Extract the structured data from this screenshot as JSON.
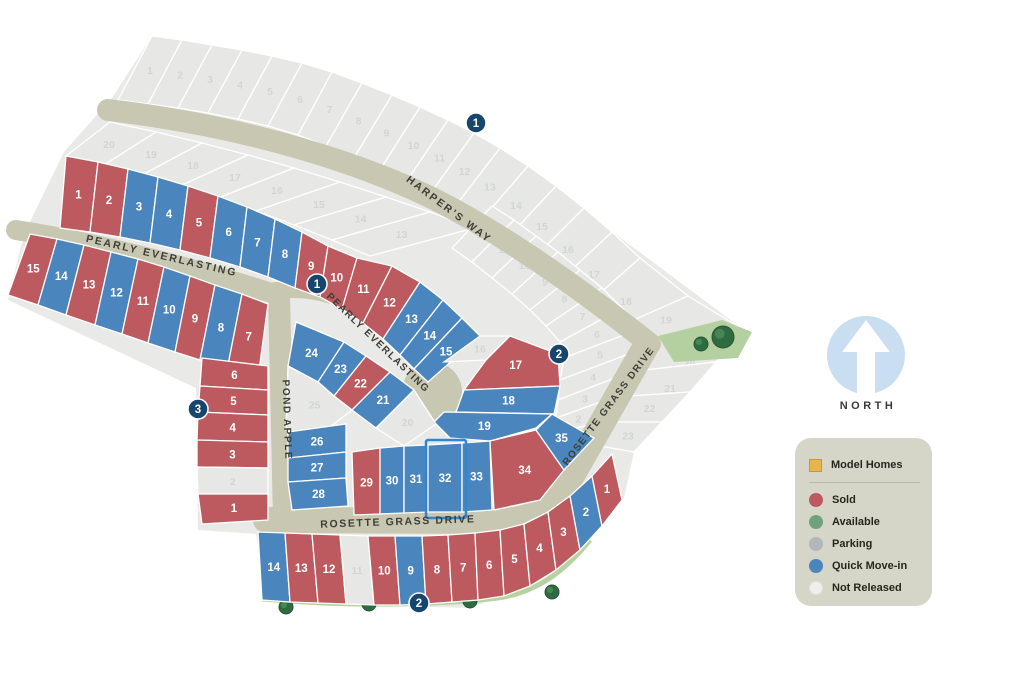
{
  "title": "Community site plan lot map",
  "compass": {
    "label": "NORTH"
  },
  "streets": {
    "harpers_way": "HARPER'S WAY",
    "pearly_everlasting": "PEARLY EVERLASTING",
    "pond_apple": "POND APPLE",
    "rosette_grass_drive": "ROSETTE GRASS DRIVE"
  },
  "markers": [
    {
      "label": "1"
    },
    {
      "label": "1"
    },
    {
      "label": "2"
    },
    {
      "label": "3"
    },
    {
      "label": "2"
    }
  ],
  "selected_lot": "32",
  "legend": {
    "model_homes_label": "Model Homes",
    "items": [
      {
        "key": "sold",
        "label": "Sold"
      },
      {
        "key": "available",
        "label": "Available"
      },
      {
        "key": "parking",
        "label": "Parking"
      },
      {
        "key": "quick",
        "label": "Quick Move-in"
      },
      {
        "key": "not_released",
        "label": "Not Released"
      }
    ]
  },
  "status_colors": {
    "sold": "#bc5a5f",
    "available": "#6fa37f",
    "parking": "#b4b7b9",
    "quick": "#4a86bd",
    "not_released": "#e7e8e5",
    "model": "#e7b54a"
  },
  "map_colors": {
    "land": "#e9eae7",
    "road": "#c7c7b2",
    "marker": "#16466d",
    "park": "#b5d0a0",
    "tree": "#2f6b41",
    "strip": "#b7d2a0",
    "legend_bg": "#d6d6c8",
    "selected_outline": "#2f86d2",
    "compass_blue": "#c9def0"
  },
  "blocks": {
    "north_row": [
      {
        "num": "1",
        "status": "sold"
      },
      {
        "num": "2",
        "status": "sold"
      },
      {
        "num": "3",
        "status": "quick"
      },
      {
        "num": "4",
        "status": "quick"
      },
      {
        "num": "5",
        "status": "sold"
      },
      {
        "num": "6",
        "status": "quick"
      },
      {
        "num": "7",
        "status": "quick"
      },
      {
        "num": "8",
        "status": "quick"
      },
      {
        "num": "9",
        "status": "sold"
      },
      {
        "num": "10",
        "status": "sold"
      },
      {
        "num": "11",
        "status": "sold"
      },
      {
        "num": "12",
        "status": "sold"
      },
      {
        "num": "13",
        "status": "quick"
      },
      {
        "num": "14",
        "status": "quick"
      },
      {
        "num": "15",
        "status": "quick"
      },
      {
        "num": "16",
        "status": "not_released"
      },
      {
        "num": "17",
        "status": "sold"
      },
      {
        "num": "18",
        "status": "quick"
      },
      {
        "num": "19",
        "status": "quick"
      }
    ],
    "south_row": [
      {
        "num": "15",
        "status": "sold"
      },
      {
        "num": "14",
        "status": "quick"
      },
      {
        "num": "13",
        "status": "sold"
      },
      {
        "num": "12",
        "status": "quick"
      },
      {
        "num": "11",
        "status": "sold"
      },
      {
        "num": "10",
        "status": "quick"
      },
      {
        "num": "9",
        "status": "sold"
      },
      {
        "num": "8",
        "status": "quick"
      },
      {
        "num": "7",
        "status": "sold"
      }
    ],
    "pond_row": [
      {
        "num": "6",
        "status": "sold"
      },
      {
        "num": "5",
        "status": "sold"
      },
      {
        "num": "4",
        "status": "sold"
      },
      {
        "num": "3",
        "status": "sold"
      },
      {
        "num": "2",
        "status": "not_released"
      },
      {
        "num": "1",
        "status": "sold"
      }
    ],
    "interior": [
      {
        "num": "24",
        "status": "quick"
      },
      {
        "num": "23",
        "status": "quick"
      },
      {
        "num": "22",
        "status": "sold"
      },
      {
        "num": "21",
        "status": "quick"
      },
      {
        "num": "20",
        "status": "not_released"
      },
      {
        "num": "25",
        "status": "not_released"
      },
      {
        "num": "26",
        "status": "quick"
      },
      {
        "num": "27",
        "status": "quick"
      },
      {
        "num": "28",
        "status": "quick"
      }
    ],
    "rosette_row": [
      {
        "num": "29",
        "status": "sold"
      },
      {
        "num": "30",
        "status": "quick"
      },
      {
        "num": "31",
        "status": "quick"
      },
      {
        "num": "32",
        "status": "quick"
      },
      {
        "num": "33",
        "status": "quick"
      },
      {
        "num": "34",
        "status": "sold"
      },
      {
        "num": "35",
        "status": "quick"
      }
    ],
    "south_band": [
      {
        "num": "14",
        "status": "quick"
      },
      {
        "num": "13",
        "status": "sold"
      },
      {
        "num": "12",
        "status": "sold"
      },
      {
        "num": "11",
        "status": "not_released"
      },
      {
        "num": "10",
        "status": "sold"
      },
      {
        "num": "9",
        "status": "quick"
      },
      {
        "num": "8",
        "status": "sold"
      },
      {
        "num": "7",
        "status": "sold"
      },
      {
        "num": "6",
        "status": "sold"
      },
      {
        "num": "5",
        "status": "sold"
      },
      {
        "num": "4",
        "status": "sold"
      },
      {
        "num": "3",
        "status": "sold"
      },
      {
        "num": "2",
        "status": "quick"
      },
      {
        "num": "1",
        "status": "sold"
      }
    ],
    "outer_band": [
      {
        "num": "1",
        "status": "not_released"
      },
      {
        "num": "2",
        "status": "not_released"
      },
      {
        "num": "3",
        "status": "not_released"
      },
      {
        "num": "4",
        "status": "not_released"
      },
      {
        "num": "5",
        "status": "not_released"
      },
      {
        "num": "6",
        "status": "not_released"
      },
      {
        "num": "7",
        "status": "not_released"
      },
      {
        "num": "8",
        "status": "not_released"
      },
      {
        "num": "9",
        "status": "not_released"
      },
      {
        "num": "10",
        "status": "not_released"
      },
      {
        "num": "11",
        "status": "not_released"
      },
      {
        "num": "12",
        "status": "not_released"
      },
      {
        "num": "13",
        "status": "not_released"
      },
      {
        "num": "14",
        "status": "not_released"
      },
      {
        "num": "15",
        "status": "not_released"
      },
      {
        "num": "16",
        "status": "not_released"
      },
      {
        "num": "17",
        "status": "not_released"
      },
      {
        "num": "18",
        "status": "not_released"
      },
      {
        "num": "19",
        "status": "not_released"
      },
      {
        "num": "20",
        "status": "not_released"
      },
      {
        "num": "21",
        "status": "not_released"
      },
      {
        "num": "22",
        "status": "not_released"
      },
      {
        "num": "23",
        "status": "not_released"
      }
    ],
    "inner_band": [
      {
        "num": "20",
        "status": "not_released"
      },
      {
        "num": "19",
        "status": "not_released"
      },
      {
        "num": "18",
        "status": "not_released"
      },
      {
        "num": "17",
        "status": "not_released"
      },
      {
        "num": "16",
        "status": "not_released"
      },
      {
        "num": "15",
        "status": "not_released"
      },
      {
        "num": "14",
        "status": "not_released"
      },
      {
        "num": "13",
        "status": "not_released"
      }
    ],
    "east_col": [
      {
        "num": "12",
        "status": "not_released"
      },
      {
        "num": "11",
        "status": "not_released"
      },
      {
        "num": "10",
        "status": "not_released"
      },
      {
        "num": "9",
        "status": "not_released"
      },
      {
        "num": "8",
        "status": "not_released"
      },
      {
        "num": "7",
        "status": "not_released"
      },
      {
        "num": "6",
        "status": "not_released"
      },
      {
        "num": "5",
        "status": "not_released"
      },
      {
        "num": "4",
        "status": "not_released"
      },
      {
        "num": "3",
        "status": "not_released"
      },
      {
        "num": "2",
        "status": "not_released"
      },
      {
        "num": "1",
        "status": "not_released"
      }
    ]
  }
}
